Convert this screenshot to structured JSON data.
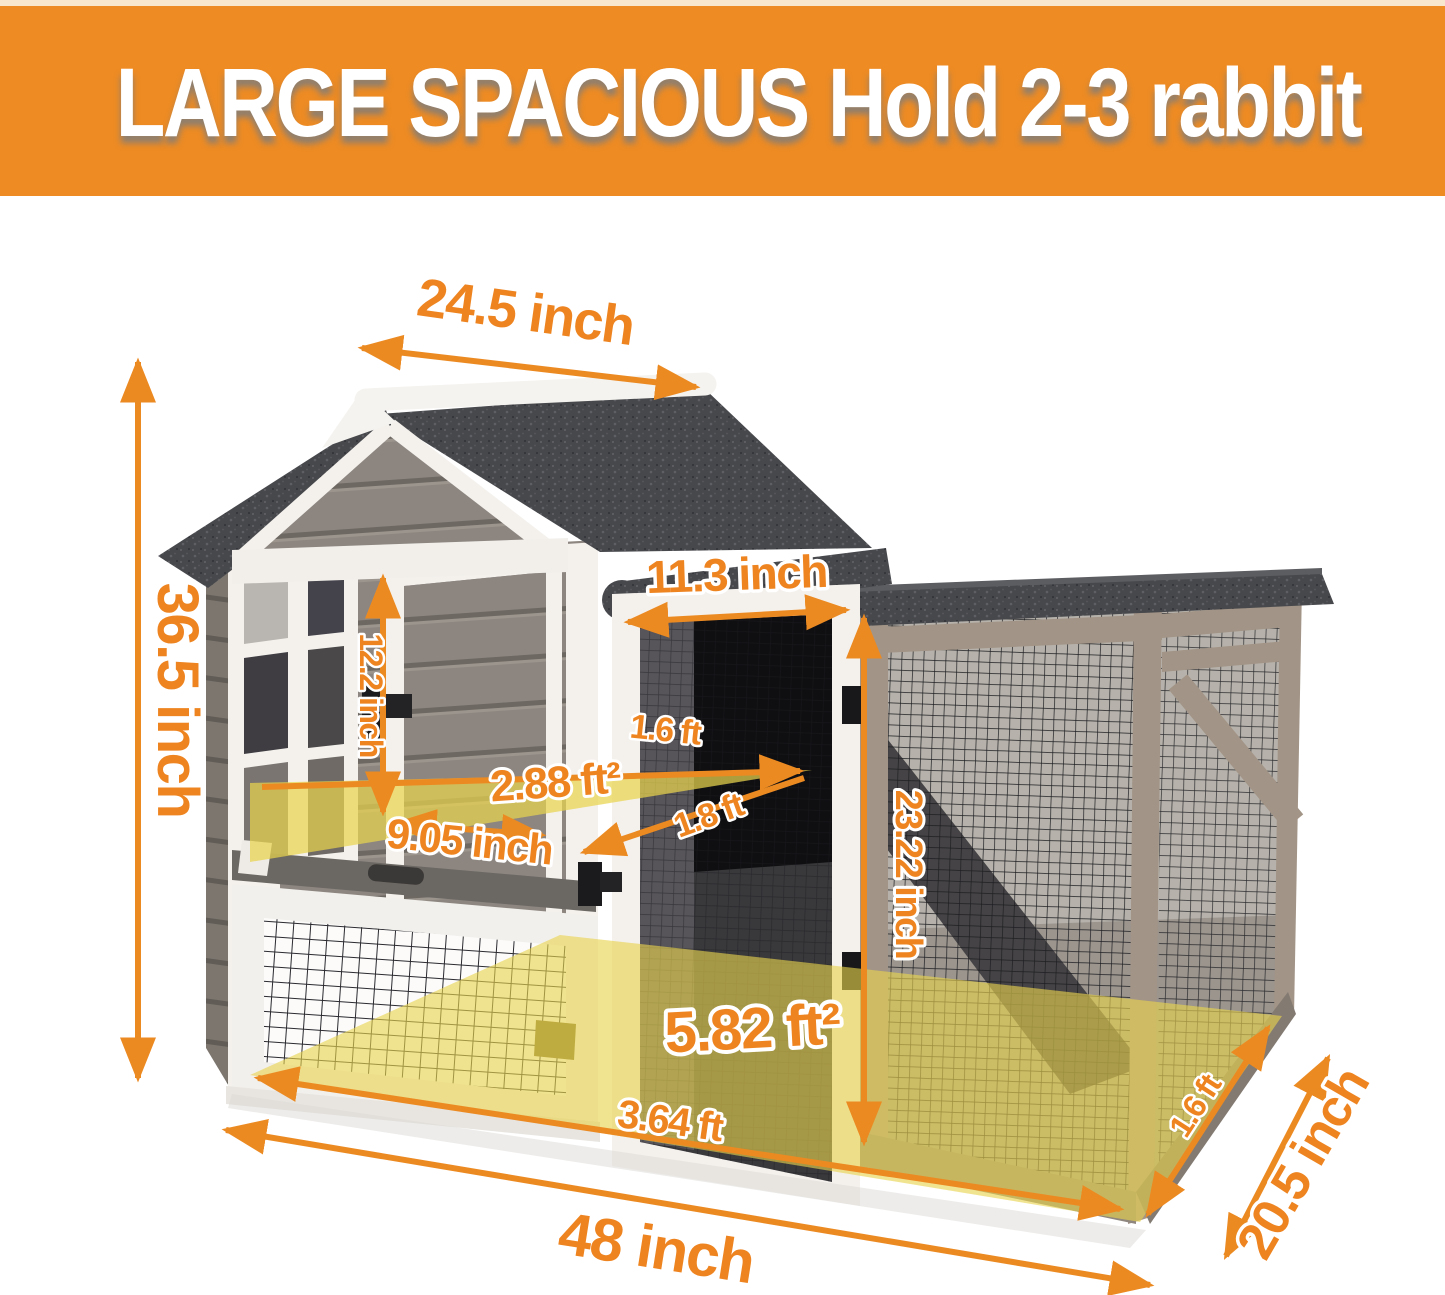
{
  "header": {
    "title": "LARGE SPACIOUS Hold 2-3 rabbit",
    "background_color": "#ee8b23",
    "text_color": "#ffffff"
  },
  "annotations": {
    "roof_width": "24.5 inch",
    "total_height": "36.5 inch",
    "door_width": "11.3 inch",
    "door_height": "12.2 inch",
    "platform_depth": "1.6 ft",
    "platform_area": "2.88 ft²",
    "platform_width": "9.05 inch",
    "platform_diagonal": "1.8 ft",
    "run_height": "23.22 inch",
    "floor_area": "5.82 ft²",
    "floor_width": "3.64 ft",
    "total_width": "48 inch",
    "total_depth": "20.5 inch",
    "run_depth": "1.6 ft"
  },
  "style": {
    "dimension_color": "#ee8420",
    "highlight_color": "#e9d44e",
    "roof_color": "#47484c",
    "siding_color": "#8d8680",
    "trim_color": "#f4f1ed",
    "frame_color": "#a29486"
  }
}
